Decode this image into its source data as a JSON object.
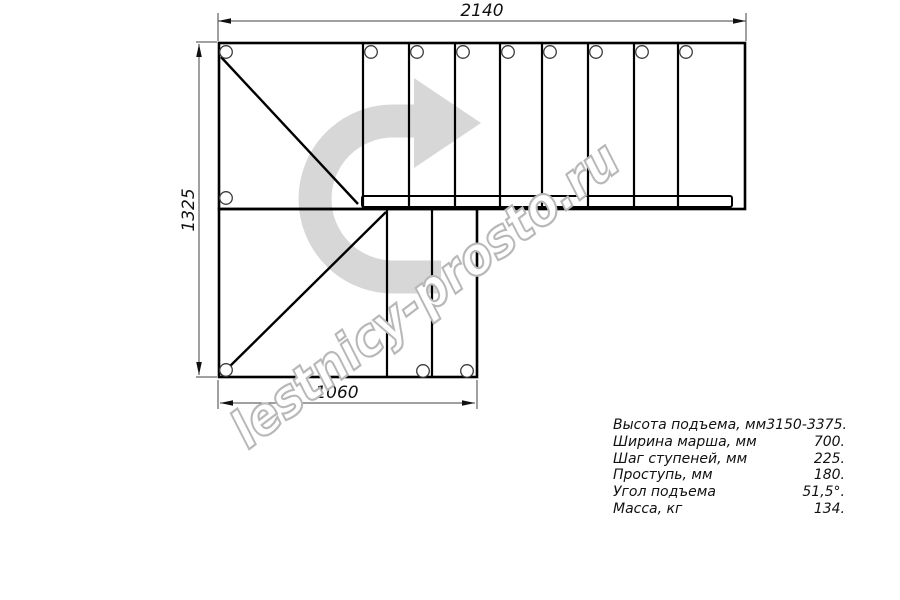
{
  "drawing": {
    "title": "staircase-plan-top-view",
    "dimensions": {
      "top": "2140",
      "left": "1325",
      "bottom": "1060"
    },
    "watermark": "lestnicy-prosto.ru",
    "icons": {
      "direction_arrow": "u-turn-right-travel-arrow"
    },
    "colors": {
      "line": "#000000",
      "dimension_line": "#404040",
      "direction_arrow": "#d7d7d7",
      "watermark_outline": "#b8b8b8"
    }
  },
  "specs": {
    "rows": [
      {
        "label": "Высота подъема, мм",
        "value": "3150-3375."
      },
      {
        "label": "Ширина марша, мм",
        "value": "700."
      },
      {
        "label": "Шаг ступеней, мм",
        "value": "225."
      },
      {
        "label": "Проступь, мм",
        "value": "180."
      },
      {
        "label": "Угол подъема",
        "value": "51,5°."
      },
      {
        "label": "Масса, кг",
        "value": "134."
      }
    ]
  }
}
